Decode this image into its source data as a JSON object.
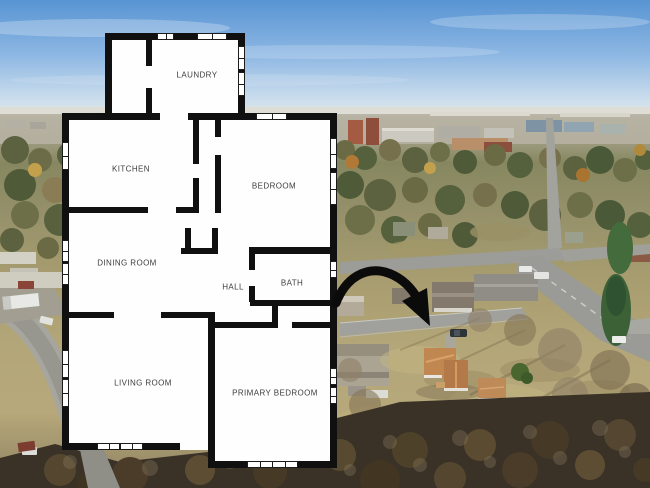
{
  "image": {
    "kind": "aerial photo with floor plan overlay",
    "annotation": "black curved arrow pointing to subject house"
  },
  "floorplan": {
    "rooms": [
      {
        "id": "laundry",
        "label": "LAUNDRY"
      },
      {
        "id": "kitchen",
        "label": "KITCHEN"
      },
      {
        "id": "bedroom",
        "label": "BEDROOM"
      },
      {
        "id": "dining-room",
        "label": "DINING ROOM"
      },
      {
        "id": "hall",
        "label": "HALL"
      },
      {
        "id": "bath",
        "label": "BATH"
      },
      {
        "id": "living-room",
        "label": "LIVING ROOM"
      },
      {
        "id": "primary-bedroom",
        "label": "PRIMARY BEDROOM"
      }
    ],
    "colors": {
      "walls": "#101010",
      "floor": "#ffffff",
      "labels": "#3d3d3d"
    }
  },
  "photo": {
    "colors": {
      "sky": "#6aa2dc",
      "grass": "#b3a476",
      "road": "#9a9a96",
      "subject_roof": "#c08850",
      "arrow": "#0b0b0b"
    }
  }
}
